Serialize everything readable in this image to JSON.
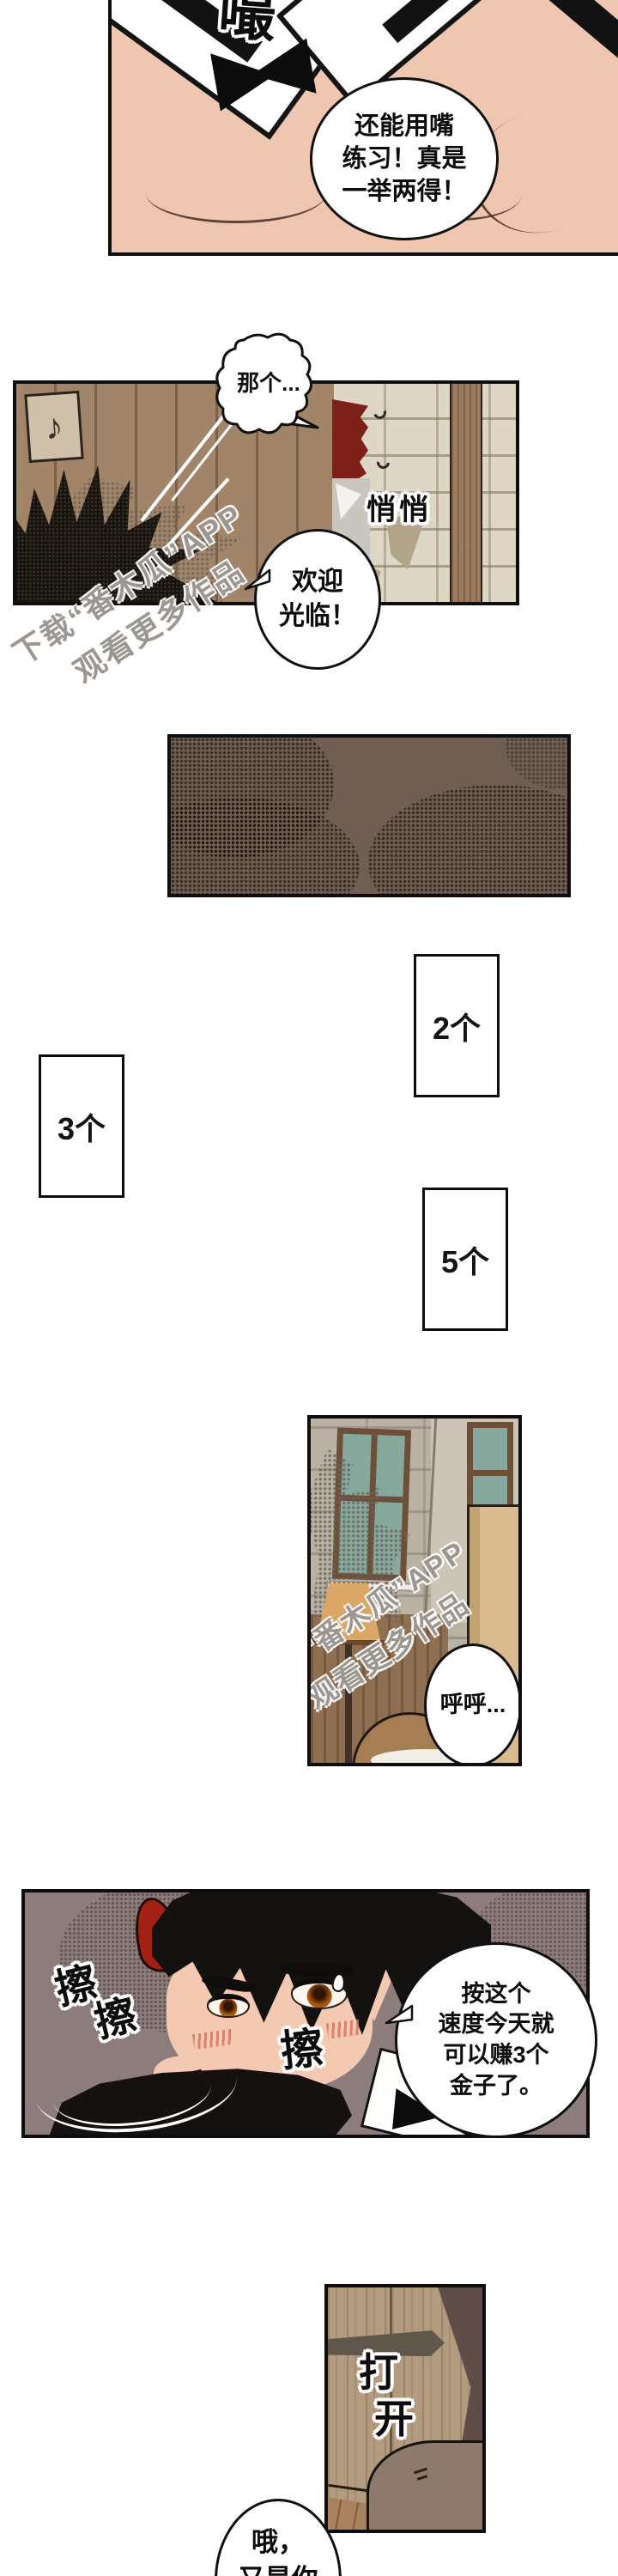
{
  "page_type": "webtoon comic page (vertical scroll, Chinese)",
  "watermark": {
    "line1": "下载“番木瓜”APP",
    "line2": "观看更多作品"
  },
  "panel1": {
    "sfx_slurp": "嘬",
    "speech": "还能用嘴\n练习！真是\n一举两得！"
  },
  "panel2": {
    "thought": "那个...",
    "sfx_sneak": "悄悄",
    "speech_welcome": "欢迎\n光临！",
    "sign_note": "♪"
  },
  "count_boxes": {
    "box_a": "2个",
    "box_b": "3个",
    "box_c": "5个"
  },
  "panel5": {
    "speech_breath": "呼呼..."
  },
  "panel6": {
    "sfx_wipe_a": "擦",
    "sfx_wipe_b": "擦",
    "sfx_wipe_c": "擦",
    "speech_gold": "按这个\n速度今天就\n可以赚3个\n金子了。"
  },
  "panel7": {
    "sfx_open_char1": "打",
    "sfx_open_char2": "开"
  },
  "panel8": {
    "speech_reply": "哦，\n又是你"
  },
  "colors": {
    "skin": "#f2c9b2",
    "hair_red": "#7d2017",
    "horn_red": "#a32015",
    "wood_wall": "#a28569",
    "stone_wall": "#ded7c5",
    "dark_panel": "#6f5e51",
    "mauve_bg": "#8d7c7c",
    "door_wood": "#b29b7e",
    "window_glass": "#87a89d",
    "outline_black": "#0e0e0e"
  }
}
